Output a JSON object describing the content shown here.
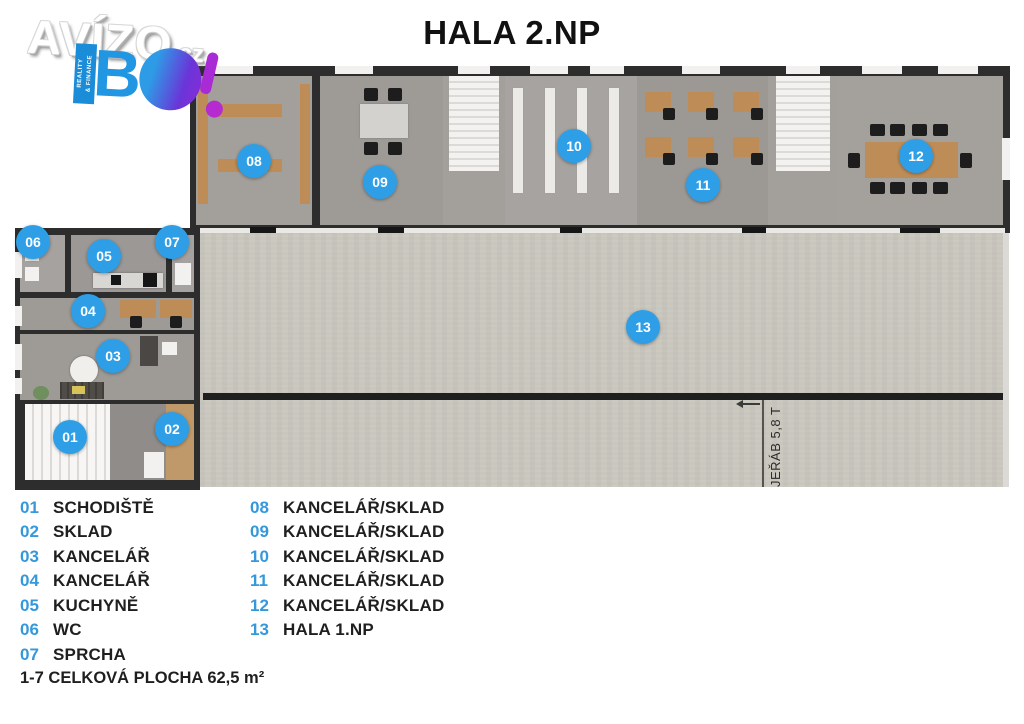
{
  "logo": {
    "brand": "AVÍZO",
    "tld": ".cz",
    "bo_letter": "B",
    "ribbon_line1": "REALITY",
    "ribbon_line2": "& FINANCE"
  },
  "title": "HALA 2.NP",
  "floorplan": {
    "crane_label": "JEŘÁB 5,8 T",
    "markers": [
      {
        "num": "01"
      },
      {
        "num": "02"
      },
      {
        "num": "03"
      },
      {
        "num": "04"
      },
      {
        "num": "05"
      },
      {
        "num": "06"
      },
      {
        "num": "07"
      },
      {
        "num": "08"
      },
      {
        "num": "09"
      },
      {
        "num": "10"
      },
      {
        "num": "11"
      },
      {
        "num": "12"
      },
      {
        "num": "13"
      }
    ]
  },
  "legend": {
    "columns": [
      {
        "items": [
          {
            "num": "01",
            "label": "SCHODIŠTĚ"
          },
          {
            "num": "02",
            "label": "SKLAD"
          },
          {
            "num": "03",
            "label": "KANCELÁŘ"
          },
          {
            "num": "04",
            "label": "KANCELÁŘ"
          },
          {
            "num": "05",
            "label": "KUCHYNĚ"
          },
          {
            "num": "06",
            "label": "WC"
          },
          {
            "num": "07",
            "label": "SPRCHA"
          }
        ]
      },
      {
        "items": [
          {
            "num": "08",
            "label": "KANCELÁŘ/SKLAD"
          },
          {
            "num": "09",
            "label": "KANCELÁŘ/SKLAD"
          },
          {
            "num": "10",
            "label": "KANCELÁŘ/SKLAD"
          },
          {
            "num": "11",
            "label": "KANCELÁŘ/SKLAD"
          },
          {
            "num": "12",
            "label": "KANCELÁŘ/SKLAD"
          },
          {
            "num": "13",
            "label": "HALA 1.NP"
          }
        ]
      }
    ],
    "footer": "1-7 CELKOVÁ PLOCHA 62,5 m²"
  },
  "colors": {
    "marker_blue": "#2E9FE6",
    "legend_blue": "#3598DB",
    "wall": "#2D2D2D",
    "hall_floor": "#C9C6BE",
    "room_floor": "#A09D99",
    "wood": "#BE8D57",
    "brand_blue": "#2196E3",
    "brand_purple": "#8A2BD6"
  }
}
